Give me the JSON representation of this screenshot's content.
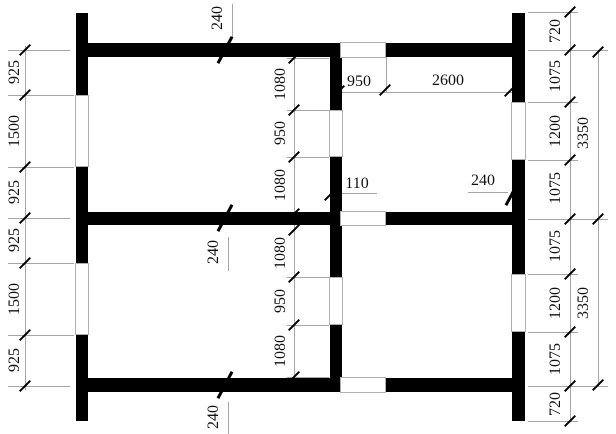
{
  "colors": {
    "wall": "#000000",
    "dimension_line": "#a6a6a6",
    "text": "#111111"
  },
  "dims": {
    "left_chain": [
      "925",
      "1500",
      "925",
      "925",
      "1500",
      "925"
    ],
    "right_chain": [
      "720",
      "1075",
      "1200",
      "1075",
      "1075",
      "1200",
      "1075",
      "720"
    ],
    "right_totals": [
      "3350",
      "3350"
    ],
    "center_chain": [
      "1080",
      "950",
      "1080",
      "1080",
      "950",
      "1080"
    ],
    "top_wall_thickness": "240",
    "middle_wall_thickness": "240",
    "bottom_wall_thickness": "240",
    "right_wall_thickness": "240",
    "opening_width": "950",
    "room_span": "2600",
    "wall_offset": "110"
  }
}
